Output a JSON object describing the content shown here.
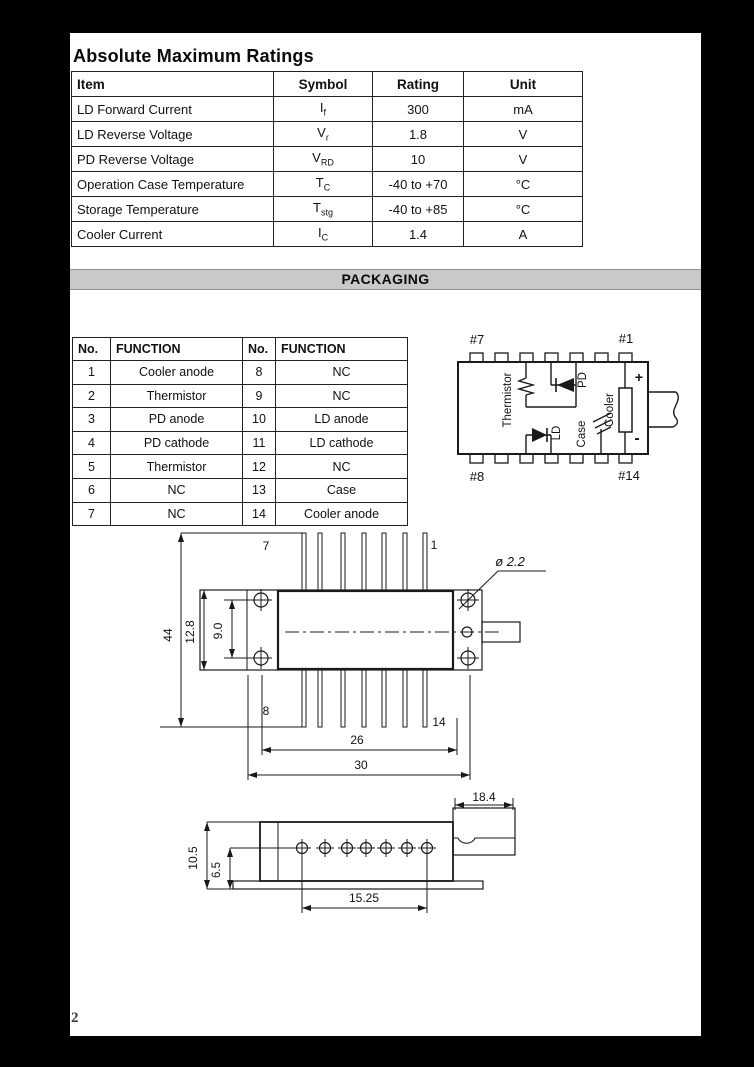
{
  "ratings": {
    "title": "Absolute Maximum Ratings",
    "headers": [
      "Item",
      "Symbol",
      "Rating",
      "Unit"
    ],
    "rows": [
      {
        "item": "LD Forward Current",
        "sym": "I",
        "sub": "f",
        "rating": "300",
        "unit": "mA"
      },
      {
        "item": "LD Reverse Voltage",
        "sym": "V",
        "sub": "r",
        "rating": "1.8",
        "unit": "V"
      },
      {
        "item": "PD Reverse Voltage",
        "sym": "V",
        "sub": "RD",
        "rating": "10",
        "unit": "V"
      },
      {
        "item": "Operation Case Temperature",
        "sym": "T",
        "sub": "C",
        "rating": "-40 to +70",
        "unit": "°C"
      },
      {
        "item": "Storage Temperature",
        "sym": "T",
        "sub": "stg",
        "rating": "-40 to +85",
        "unit": "°C"
      },
      {
        "item": "Cooler Current",
        "sym": "I",
        "sub": "C",
        "rating": "1.4",
        "unit": "A"
      }
    ]
  },
  "packaging": {
    "title": "PACKAGING"
  },
  "pin_table": {
    "headers": [
      "No.",
      "FUNCTION",
      "No.",
      "FUNCTION"
    ],
    "rows": [
      {
        "no1": "1",
        "fn1": "Cooler anode",
        "no2": "8",
        "fn2": "NC"
      },
      {
        "no1": "2",
        "fn1": "Thermistor",
        "no2": "9",
        "fn2": "NC"
      },
      {
        "no1": "3",
        "fn1": "PD anode",
        "no2": "10",
        "fn2": "LD anode"
      },
      {
        "no1": "4",
        "fn1": "PD cathode",
        "no2": "11",
        "fn2": "LD cathode"
      },
      {
        "no1": "5",
        "fn1": "Thermistor",
        "no2": "12",
        "fn2": "NC"
      },
      {
        "no1": "6",
        "fn1": "NC",
        "no2": "13",
        "fn2": "Case"
      },
      {
        "no1": "7",
        "fn1": "NC",
        "no2": "14",
        "fn2": "Cooler anode"
      }
    ]
  },
  "schematic": {
    "pin7": "#7",
    "pin1": "#1",
    "pin8": "#8",
    "pin14": "#14",
    "thermistor": "Thermistor",
    "pd": "PD",
    "ld": "LD",
    "case": "Case",
    "cooler": "Cooler",
    "plus": "+",
    "minus": "-"
  },
  "top_view": {
    "p7": "7",
    "p1": "1",
    "p8": "8",
    "p14": "14",
    "d44": "44",
    "d12_8": "12.8",
    "d9_0": "9.0",
    "dia": "ø 2.2",
    "d26": "26",
    "d30": "30"
  },
  "side_view": {
    "d18_4": "18.4",
    "d10_5": "10.5",
    "d6_5": "6.5",
    "d15_25": "15.25"
  },
  "footer": {
    "page_number": "2"
  }
}
